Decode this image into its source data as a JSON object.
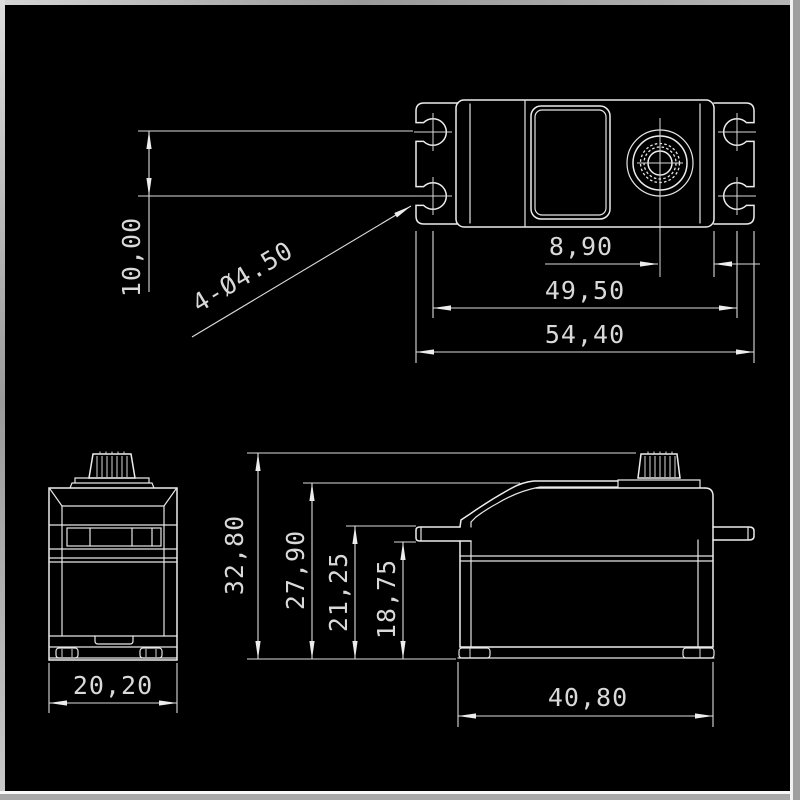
{
  "drawing": {
    "title": "Servo dimensional drawing (three orthographic views)",
    "unit": "mm",
    "views": {
      "top_view": {
        "label": "top-view",
        "dims": {
          "hole_row_spacing": "10,00",
          "mount_holes": "4-Ø4.50",
          "shaft_to_edge": "8,90",
          "hole_col_spacing": "49,50",
          "overall_width": "54,40"
        }
      },
      "front_view": {
        "label": "front-view",
        "dims": {
          "body_width": "20,20"
        }
      },
      "side_view": {
        "label": "side-view",
        "dims": {
          "overall_height": "32,80",
          "case_height": "27,90",
          "flange_top_height": "21,25",
          "flange_bottom_height": "18,75",
          "body_length": "40,80"
        }
      }
    }
  },
  "colors": {
    "canvas": "#000000",
    "line": "#ededed",
    "text": "#d9d9d9",
    "frame": "#a5a5a5",
    "frame_highlight": "#f8f8f8"
  }
}
